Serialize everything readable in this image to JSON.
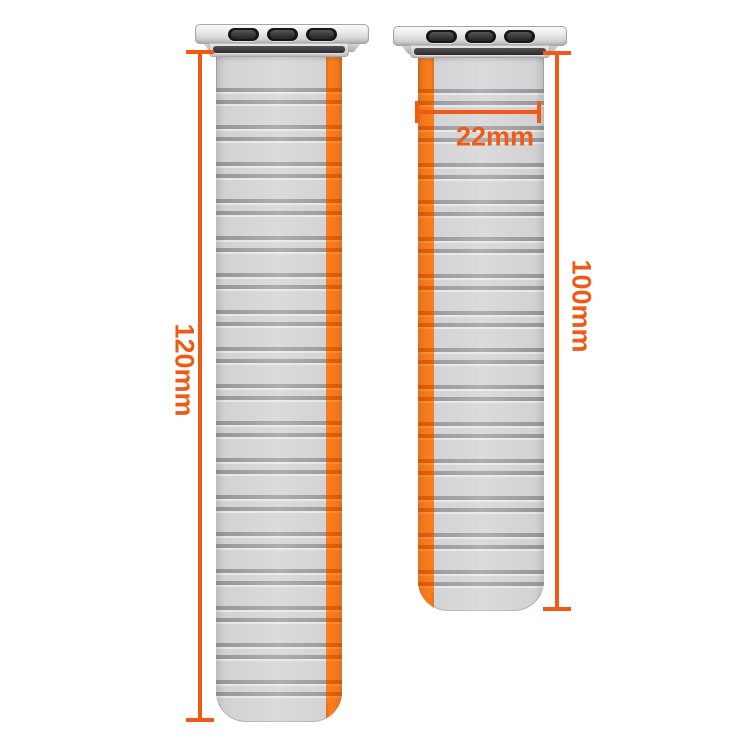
{
  "bands": {
    "long_band": {
      "description_name": "long-strap-segment",
      "length_label": "120mm"
    },
    "short_band": {
      "description_name": "short-strap-segment",
      "length_label": "100mm",
      "width_label": "22mm"
    }
  },
  "colors": {
    "strap_gray": "#d2d2d4",
    "ridge_gray": "#99999b",
    "stripe_orange": "#fa7b1a",
    "dimension_orange": "#f15a14",
    "adapter_silver": "#d6d6d9",
    "pin_black": "#161618"
  }
}
